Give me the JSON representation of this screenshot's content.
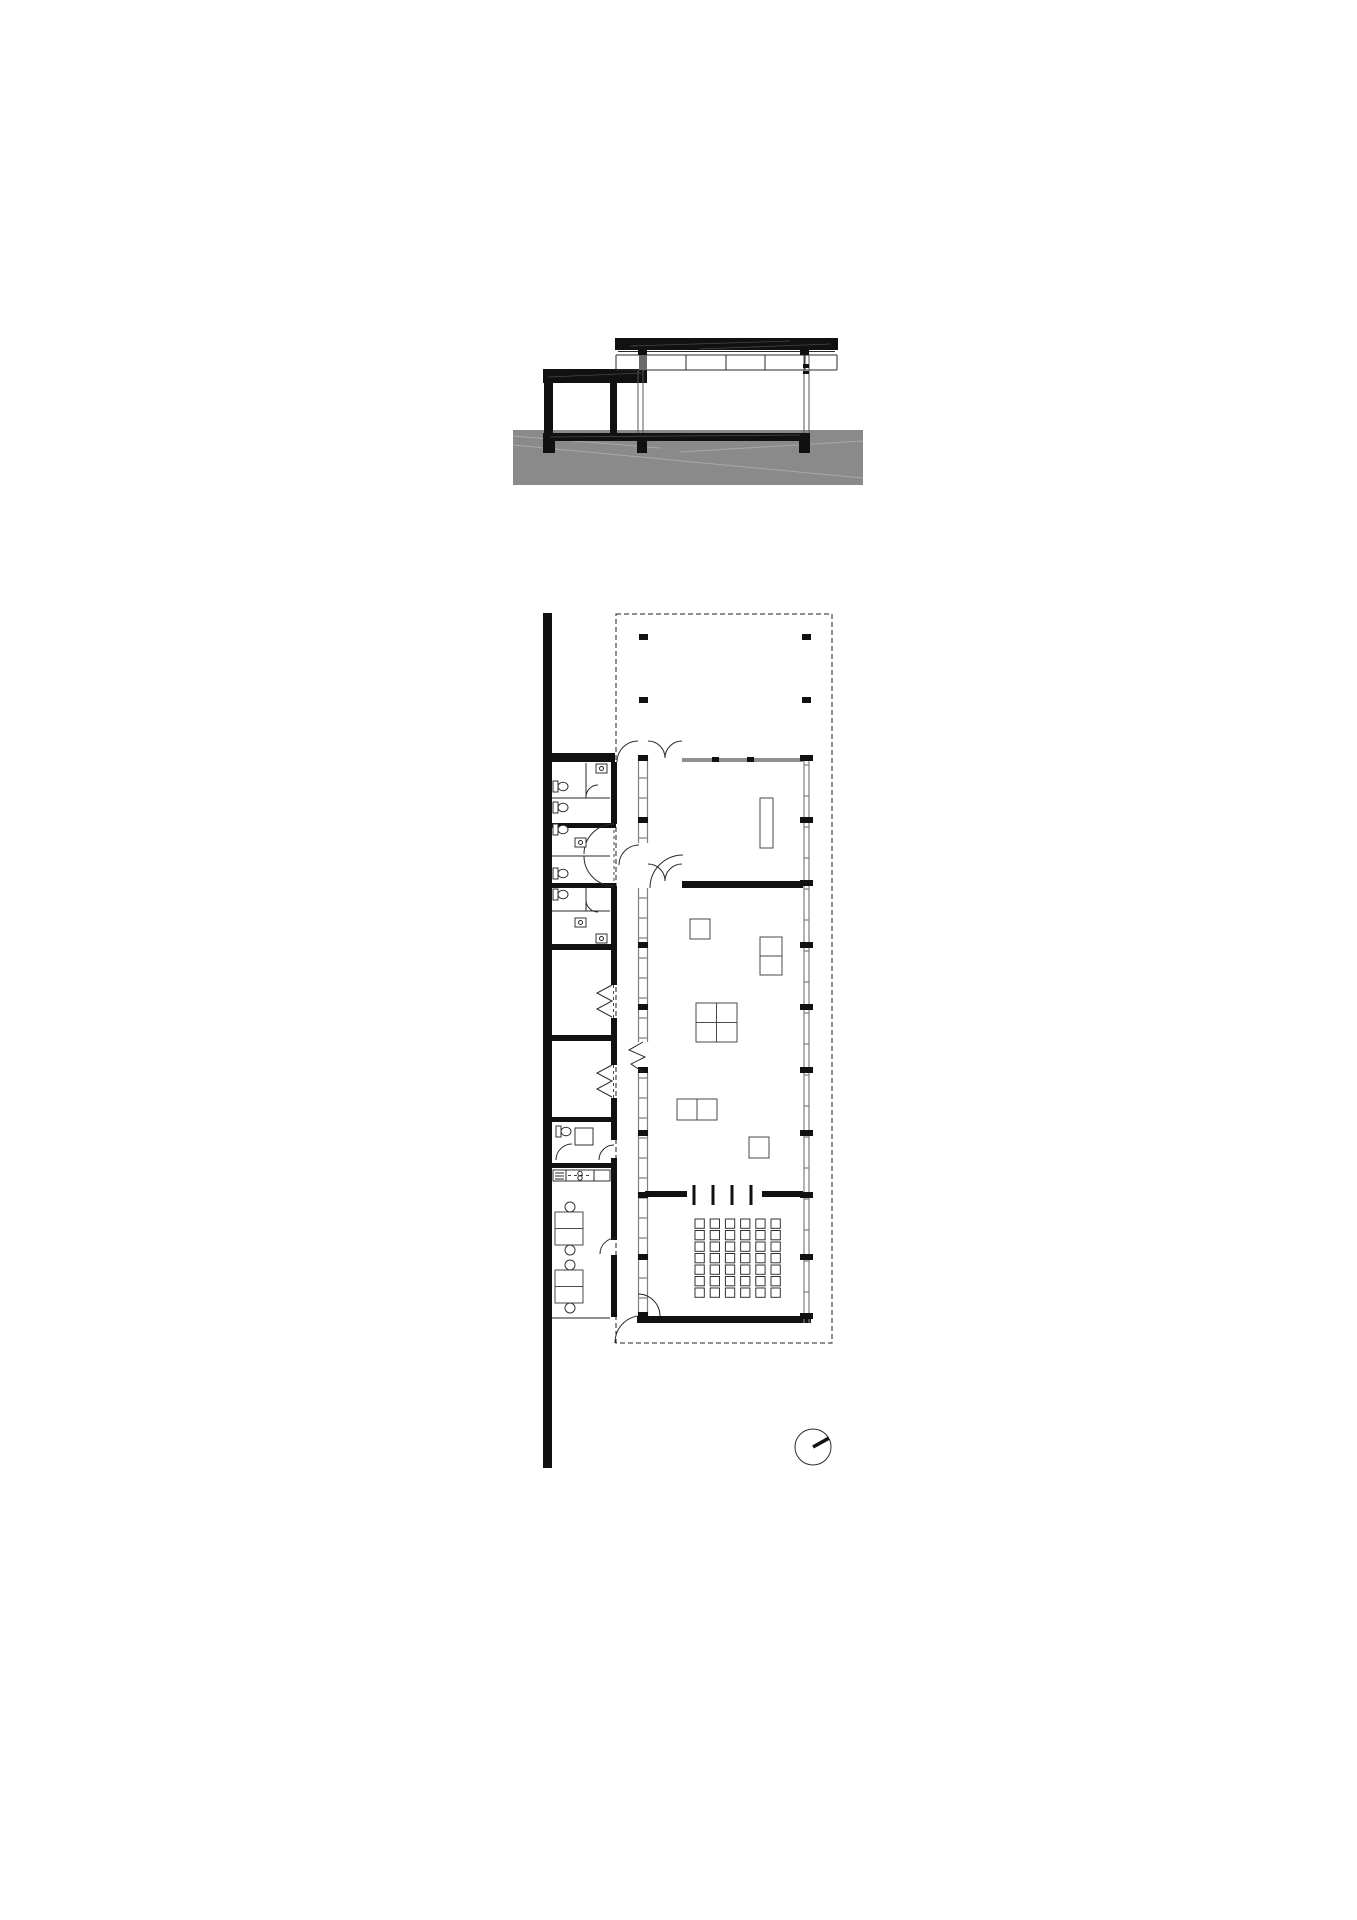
{
  "document": {
    "type": "architectural-drawing",
    "sheet": "pavilion section and ground floor plan",
    "views": {
      "top": "cross / longitudinal section with low canopy wing, glazed pavilion and ground mass",
      "bottom": "floor plan with service wing, hall, auditorium seating and roofed terrace (dashed)",
      "symbol": "north-arrow compass, needle pointing upper-right"
    }
  },
  "colors": {
    "background": "#ffffff",
    "line": "#1c1c1c",
    "ground": "#8a8a8a",
    "ground_hatch": "#a8a8a8",
    "glazing": "#7f7f7f",
    "connector": "#6a6a6a"
  },
  "section": {
    "ground": {
      "x": 513,
      "y": 430,
      "w": 350,
      "h": 55
    },
    "ground_hatch_lines": [
      [
        513,
        445,
        863,
        478
      ],
      [
        513,
        436,
        660,
        448
      ],
      [
        680,
        452,
        863,
        441
      ]
    ],
    "floor_slab": {
      "x": 543,
      "y": 433,
      "w": 267,
      "h": 8
    },
    "foundations": [
      [
        543,
        441,
        12,
        12
      ],
      [
        637,
        441,
        10,
        12
      ],
      [
        799,
        441,
        11,
        12
      ]
    ],
    "canopy_slab": {
      "x": 543,
      "y": 369,
      "w": 104,
      "h": 14
    },
    "canopy_columns": [
      [
        544,
        383,
        9,
        50
      ],
      [
        610,
        383,
        7,
        50
      ]
    ],
    "roof_slab": {
      "x": 615,
      "y": 338,
      "w": 223,
      "h": 12
    },
    "clerestory": {
      "y_top": 355,
      "y_bot": 370,
      "x1": 616,
      "x2": 837,
      "mullions_x": [
        643,
        686,
        726,
        765,
        805
      ]
    },
    "capitals": [
      [
        638,
        350,
        9,
        5
      ],
      [
        800,
        350,
        9,
        5
      ]
    ],
    "column_details": [
      [
        803,
        364,
        6,
        4
      ],
      [
        803,
        371,
        6,
        3
      ]
    ]
  },
  "plan": {
    "roof_outline": {
      "x": 616,
      "y": 614,
      "w": 216,
      "h": 729
    },
    "spine_wall": {
      "x": 543,
      "y": 613,
      "w": 9,
      "h": 855
    },
    "terrace_columns": [
      [
        639,
        634
      ],
      [
        802,
        634
      ],
      [
        639,
        697
      ],
      [
        802,
        697
      ]
    ],
    "grid_marker_ys_east": [
      758,
      820,
      883,
      945,
      1007,
      1070,
      1133,
      1195,
      1257,
      1316
    ],
    "grid_marker_ys_west": [
      758,
      820,
      945,
      1007,
      1070,
      1133,
      1195,
      1257,
      1315
    ],
    "east_ticks": {
      "start": 765,
      "end": 1310,
      "step": 31
    },
    "west_ticks": {
      "start": 778,
      "end": 1312,
      "step": 20,
      "skip": [
        [
          840,
          890
        ],
        [
          1040,
          1074
        ]
      ]
    },
    "pivot_door_xs": [
      694,
      713,
      732,
      751
    ],
    "auditorium_chairs": {
      "rows": 7,
      "cols": 6,
      "x": 695,
      "y": 1219,
      "pitch_x": 15.2,
      "pitch_y": 11.5,
      "size": 9.3
    },
    "tables": [
      {
        "x": 760,
        "y": 798,
        "w": 13,
        "h": 50,
        "split": "none"
      },
      {
        "x": 690,
        "y": 919,
        "w": 20,
        "h": 20,
        "split": "none"
      },
      {
        "x": 760,
        "y": 937,
        "w": 22,
        "h": 38,
        "split": "h"
      },
      {
        "x": 696,
        "y": 1003,
        "w": 41,
        "h": 39,
        "split": "cross"
      },
      {
        "x": 677,
        "y": 1099,
        "w": 40,
        "h": 21,
        "split": "v"
      },
      {
        "x": 749,
        "y": 1137,
        "w": 20,
        "h": 21,
        "split": "none"
      }
    ],
    "desk_groups": [
      {
        "x": 555,
        "y": 1212,
        "w": 28,
        "h": 33
      },
      {
        "x": 555,
        "y": 1270,
        "w": 28,
        "h": 33
      }
    ],
    "wc_fixtures": [
      [
        553,
        781
      ],
      [
        553,
        802
      ],
      [
        553,
        824
      ],
      [
        553,
        868
      ],
      [
        553,
        889
      ],
      [
        556,
        1126
      ]
    ],
    "sink_fixtures": [
      [
        596,
        764
      ],
      [
        575,
        838
      ],
      [
        575,
        918
      ],
      [
        596,
        934
      ]
    ]
  },
  "north_arrow": {
    "cx": 813,
    "cy": 1447,
    "r": 18,
    "tip_x": 828.8,
    "tip_y": 1438.2
  }
}
